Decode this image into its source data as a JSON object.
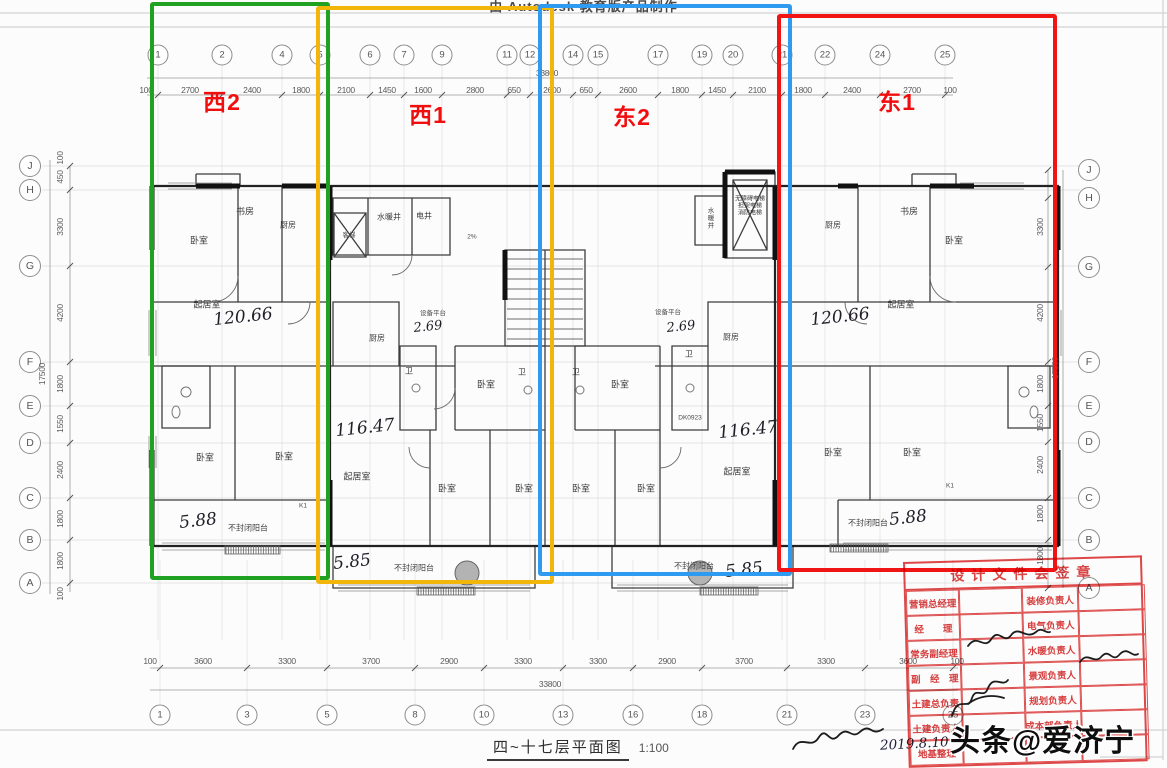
{
  "header": {
    "autodesk_text": "由 Autodesk 教育版产品制作"
  },
  "units": [
    {
      "id": "west2",
      "label": "西2",
      "color": "#21a121",
      "label_x": 222,
      "label_y": 100,
      "rect": {
        "x": 150,
        "y": 2,
        "w": 180,
        "h": 578
      }
    },
    {
      "id": "west1",
      "label": "西1",
      "color": "#f2b50a",
      "label_x": 428,
      "label_y": 113,
      "rect": {
        "x": 316,
        "y": 6,
        "w": 238,
        "h": 578
      }
    },
    {
      "id": "east2",
      "label": "东2",
      "color": "#2e9bf0",
      "label_x": 632,
      "label_y": 115,
      "rect": {
        "x": 538,
        "y": 4,
        "w": 254,
        "h": 572
      }
    },
    {
      "id": "east1",
      "label": "东1",
      "color": "#f01414",
      "label_x": 897,
      "label_y": 100,
      "rect": {
        "x": 777,
        "y": 14,
        "w": 280,
        "h": 558
      }
    }
  ],
  "grid": {
    "top_axes": [
      {
        "label": "1",
        "x": 158
      },
      {
        "label": "2",
        "x": 222
      },
      {
        "label": "4",
        "x": 282
      },
      {
        "label": "5",
        "x": 320
      },
      {
        "label": "6",
        "x": 370
      },
      {
        "label": "7",
        "x": 404
      },
      {
        "label": "9",
        "x": 442
      },
      {
        "label": "11",
        "x": 507
      },
      {
        "label": "12",
        "x": 530
      },
      {
        "label": "14",
        "x": 573
      },
      {
        "label": "15",
        "x": 598
      },
      {
        "label": "17",
        "x": 658
      },
      {
        "label": "19",
        "x": 702
      },
      {
        "label": "20",
        "x": 733
      },
      {
        "label": "21",
        "x": 782
      },
      {
        "label": "22",
        "x": 825
      },
      {
        "label": "24",
        "x": 880
      },
      {
        "label": "25",
        "x": 945
      }
    ],
    "top_dims": [
      {
        "text": "100",
        "x": 146
      },
      {
        "text": "2700",
        "x": 190
      },
      {
        "text": "2400",
        "x": 252
      },
      {
        "text": "1800",
        "x": 301
      },
      {
        "text": "2100",
        "x": 346
      },
      {
        "text": "1450",
        "x": 387
      },
      {
        "text": "1600",
        "x": 423
      },
      {
        "text": "2800",
        "x": 475
      },
      {
        "text": "650",
        "x": 514
      },
      {
        "text": "2600",
        "x": 552
      },
      {
        "text": "650",
        "x": 586
      },
      {
        "text": "2600",
        "x": 628
      },
      {
        "text": "1800",
        "x": 680
      },
      {
        "text": "1450",
        "x": 717
      },
      {
        "text": "2100",
        "x": 757
      },
      {
        "text": "1800",
        "x": 803
      },
      {
        "text": "2400",
        "x": 852
      },
      {
        "text": "2700",
        "x": 912
      },
      {
        "text": "100",
        "x": 950
      }
    ],
    "top_total": "33800",
    "bottom_axes": [
      {
        "label": "1",
        "x": 160
      },
      {
        "label": "3",
        "x": 247
      },
      {
        "label": "5",
        "x": 327
      },
      {
        "label": "8",
        "x": 415
      },
      {
        "label": "10",
        "x": 484
      },
      {
        "label": "13",
        "x": 563
      },
      {
        "label": "16",
        "x": 633
      },
      {
        "label": "18",
        "x": 702
      },
      {
        "label": "21",
        "x": 787
      },
      {
        "label": "23",
        "x": 865
      },
      {
        "label": "25",
        "x": 953
      }
    ],
    "bottom_dims": [
      {
        "text": "100",
        "x": 150
      },
      {
        "text": "3600",
        "x": 203
      },
      {
        "text": "3300",
        "x": 287
      },
      {
        "text": "3700",
        "x": 371
      },
      {
        "text": "2900",
        "x": 449
      },
      {
        "text": "3300",
        "x": 523
      },
      {
        "text": "3300",
        "x": 598
      },
      {
        "text": "2900",
        "x": 667
      },
      {
        "text": "3700",
        "x": 744
      },
      {
        "text": "3300",
        "x": 826
      },
      {
        "text": "3600",
        "x": 908
      },
      {
        "text": "100",
        "x": 957
      }
    ],
    "bottom_total": "33800",
    "left_axes": [
      {
        "label": "J",
        "y": 166
      },
      {
        "label": "H",
        "y": 190
      },
      {
        "label": "G",
        "y": 266
      },
      {
        "label": "F",
        "y": 362
      },
      {
        "label": "E",
        "y": 406
      },
      {
        "label": "D",
        "y": 443
      },
      {
        "label": "C",
        "y": 498
      },
      {
        "label": "B",
        "y": 540
      },
      {
        "label": "A",
        "y": 583
      }
    ],
    "left_dims": [
      {
        "text": "100",
        "y": 158
      },
      {
        "text": "450",
        "y": 177
      },
      {
        "text": "3300",
        "y": 227
      },
      {
        "text": "4200",
        "y": 313
      },
      {
        "text": "1800",
        "y": 384
      },
      {
        "text": "1550",
        "y": 424
      },
      {
        "text": "2400",
        "y": 470
      },
      {
        "text": "1800",
        "y": 519
      },
      {
        "text": "1800",
        "y": 561
      },
      {
        "text": "100",
        "y": 594
      }
    ],
    "left_total": "17500",
    "right_axes": [
      {
        "label": "J",
        "y": 170
      },
      {
        "label": "H",
        "y": 198
      },
      {
        "label": "G",
        "y": 267
      },
      {
        "label": "F",
        "y": 362
      },
      {
        "label": "E",
        "y": 406
      },
      {
        "label": "D",
        "y": 442
      },
      {
        "label": "C",
        "y": 498
      },
      {
        "label": "B",
        "y": 540
      },
      {
        "label": "A",
        "y": 588
      }
    ],
    "right_dims": [
      {
        "text": "3300",
        "y": 227
      },
      {
        "text": "4200",
        "y": 313
      },
      {
        "text": "1800",
        "y": 384
      },
      {
        "text": "1550",
        "y": 423
      },
      {
        "text": "2400",
        "y": 465
      },
      {
        "text": "1800",
        "y": 514
      },
      {
        "text": "1800",
        "y": 556
      }
    ],
    "right_total": "17500"
  },
  "plan_labels": [
    {
      "t": "书房",
      "x": 245,
      "y": 211,
      "c": "room"
    },
    {
      "t": "厨房",
      "x": 288,
      "y": 225,
      "c": "room-sm"
    },
    {
      "t": "卧室",
      "x": 199,
      "y": 240,
      "c": "room"
    },
    {
      "t": "起居室",
      "x": 207,
      "y": 304,
      "c": "room"
    },
    {
      "t": "120.66",
      "x": 243,
      "y": 317,
      "c": "hand"
    },
    {
      "t": "卧室",
      "x": 205,
      "y": 457,
      "c": "room"
    },
    {
      "t": "卧室",
      "x": 284,
      "y": 456,
      "c": "room"
    },
    {
      "t": "5.88",
      "x": 198,
      "y": 521,
      "c": "hand"
    },
    {
      "t": "不封闭阳台",
      "x": 248,
      "y": 528,
      "c": "room-sm"
    },
    {
      "t": "K1",
      "x": 303,
      "y": 506,
      "c": "tiny"
    },
    {
      "t": "客梯",
      "x": 349,
      "y": 234,
      "c": "tiny"
    },
    {
      "t": "水暖井",
      "x": 389,
      "y": 217,
      "c": "room-sm"
    },
    {
      "t": "电井",
      "x": 424,
      "y": 216,
      "c": "room-sm"
    },
    {
      "t": "2%",
      "x": 472,
      "y": 237,
      "c": "tiny"
    },
    {
      "t": "设备平台",
      "x": 433,
      "y": 312,
      "c": "tiny"
    },
    {
      "t": "2.69",
      "x": 428,
      "y": 327,
      "c": "hand-sm"
    },
    {
      "t": "厨房",
      "x": 377,
      "y": 338,
      "c": "room-sm"
    },
    {
      "t": "卫",
      "x": 409,
      "y": 371,
      "c": "room-sm"
    },
    {
      "t": "卧室",
      "x": 486,
      "y": 384,
      "c": "room"
    },
    {
      "t": "卫",
      "x": 522,
      "y": 372,
      "c": "room-sm"
    },
    {
      "t": "116.47",
      "x": 365,
      "y": 428,
      "c": "hand"
    },
    {
      "t": "起居室",
      "x": 357,
      "y": 476,
      "c": "room"
    },
    {
      "t": "卧室",
      "x": 447,
      "y": 488,
      "c": "room"
    },
    {
      "t": "卧室",
      "x": 524,
      "y": 488,
      "c": "room"
    },
    {
      "t": "5.85",
      "x": 352,
      "y": 562,
      "c": "hand"
    },
    {
      "t": "不封闭阳台",
      "x": 414,
      "y": 568,
      "c": "room-sm"
    },
    {
      "t": "卫",
      "x": 576,
      "y": 372,
      "c": "room-sm"
    },
    {
      "t": "卧室",
      "x": 620,
      "y": 384,
      "c": "room"
    },
    {
      "t": "设备平台",
      "x": 668,
      "y": 311,
      "c": "tiny"
    },
    {
      "t": "2.69",
      "x": 681,
      "y": 327,
      "c": "hand-sm"
    },
    {
      "t": "厨房",
      "x": 731,
      "y": 337,
      "c": "room-sm"
    },
    {
      "t": "卫",
      "x": 689,
      "y": 354,
      "c": "room-sm"
    },
    {
      "t": "DK0923",
      "x": 690,
      "y": 418,
      "c": "tiny"
    },
    {
      "t": "116.47",
      "x": 748,
      "y": 430,
      "c": "hand"
    },
    {
      "t": "起居室",
      "x": 737,
      "y": 471,
      "c": "room"
    },
    {
      "t": "卧室",
      "x": 581,
      "y": 488,
      "c": "room"
    },
    {
      "t": "卧室",
      "x": 646,
      "y": 488,
      "c": "room"
    },
    {
      "t": "不封闭阳台",
      "x": 694,
      "y": 566,
      "c": "room-sm"
    },
    {
      "t": "5.85",
      "x": 744,
      "y": 570,
      "c": "hand"
    },
    {
      "t": "水暖井",
      "x": 709,
      "y": 218,
      "c": "vert"
    },
    {
      "t": "无障碍电梯\n担架电梯\n消防电梯",
      "x": 750,
      "y": 207,
      "c": "elev"
    },
    {
      "t": "厨房",
      "x": 833,
      "y": 225,
      "c": "room-sm"
    },
    {
      "t": "书房",
      "x": 909,
      "y": 211,
      "c": "room"
    },
    {
      "t": "卧室",
      "x": 954,
      "y": 240,
      "c": "room"
    },
    {
      "t": "起居室",
      "x": 901,
      "y": 304,
      "c": "room"
    },
    {
      "t": "120.66",
      "x": 840,
      "y": 317,
      "c": "hand"
    },
    {
      "t": "卧室",
      "x": 833,
      "y": 452,
      "c": "room"
    },
    {
      "t": "卧室",
      "x": 912,
      "y": 452,
      "c": "room"
    },
    {
      "t": "K1",
      "x": 950,
      "y": 486,
      "c": "tiny"
    },
    {
      "t": "不封闭阳台",
      "x": 868,
      "y": 523,
      "c": "room-sm"
    },
    {
      "t": "5.88",
      "x": 908,
      "y": 518,
      "c": "hand"
    }
  ],
  "stamp": {
    "title": "设计文件会签章",
    "left_rows": [
      "营销总经理",
      "经　　理",
      "常务副经理",
      "副　经　理",
      "土建总负责",
      "土建负责人",
      "地基整理"
    ],
    "right_rows": [
      "装修负责人",
      "电气负责人",
      "水暖负责人",
      "景观负责人",
      "规划负责人",
      "成本部负责人",
      ""
    ]
  },
  "footer": {
    "title": "四~十七层平面图",
    "scale": "1:100",
    "date": "2019.8.10"
  },
  "watermark": {
    "text": "头条@爱济宁"
  }
}
